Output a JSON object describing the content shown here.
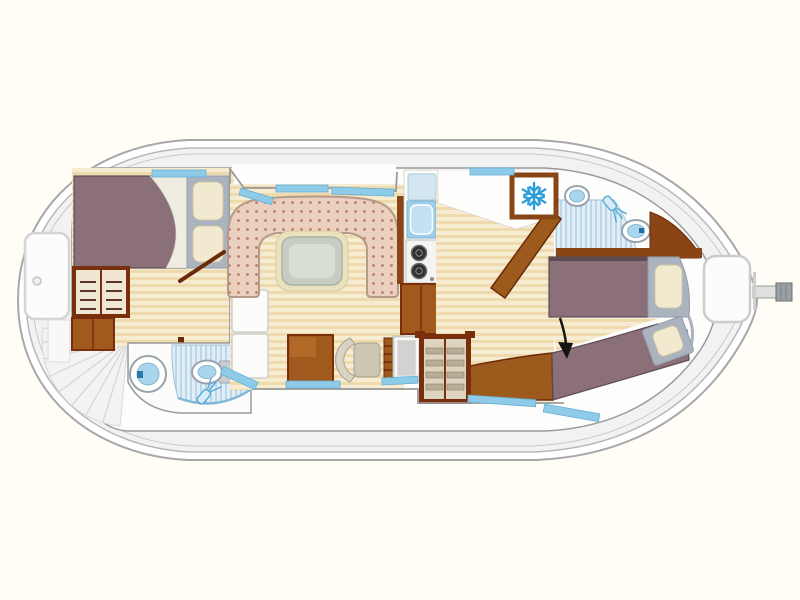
{
  "diagram": {
    "type": "boat floor plan",
    "view": "top-down deck plan"
  },
  "colors": {
    "hull_outline": "#a8a8a8",
    "deck_gray": "#f2f2f2",
    "cabin_white": "#fdfdfc",
    "wood_floor_light": "#f6ecd2",
    "wood_floor_dark": "#eedaad",
    "furniture_wood": "#a05a1e",
    "furniture_wood_dark": "#7a2f0c",
    "bed_mauve": "#8c7079",
    "bed_edge": "#5e4a52",
    "pillow_cream": "#f2eacf",
    "pillow_frame_gray": "#aab3be",
    "upholstery_pink": "#ecd0bf",
    "upholstery_dot": "#b97c62",
    "table_border": "#ece1bd",
    "table_top": "#c7cdc2",
    "window_blue": "#8ecbe8",
    "water_blue": "#a9d6ec",
    "shower_stripe": "#bcd6e8",
    "snowflake_blue": "#2b9fd6",
    "stove_burner": "#2f2f2f",
    "arrow_black": "#151515"
  },
  "icons": [
    {
      "name": "snowflake-icon",
      "meaning": "refrigerator"
    },
    {
      "name": "shower-head-icon",
      "meaning": "shower",
      "count": 2
    },
    {
      "name": "arrow-down-icon",
      "meaning": "entry indicator"
    }
  ],
  "features": {
    "bow_deck": [
      "deck hatch"
    ],
    "bow_cabin": [
      "double bed",
      "two pillows",
      "open wardrobe with shelves",
      "cabinet",
      "door"
    ],
    "forward_bathroom": [
      "washbasin",
      "shower",
      "toilet"
    ],
    "companionway": [
      "fan of steps"
    ],
    "salon": [
      "u-shaped dinette",
      "table",
      "sideboard",
      "desk",
      "chair",
      "steps",
      "appliance"
    ],
    "galley": [
      "drainboard",
      "sink",
      "two-burner stove",
      "base cabinet",
      "refrigerator"
    ],
    "aft_bathroom": [
      "washbasin",
      "shower",
      "toilet"
    ],
    "aft_cabin": [
      "single berth",
      "angled berth",
      "two pillows",
      "wardrobe with shelves",
      "bench",
      "door"
    ],
    "stern": [
      "deck hatch",
      "rudder tiller"
    ]
  }
}
